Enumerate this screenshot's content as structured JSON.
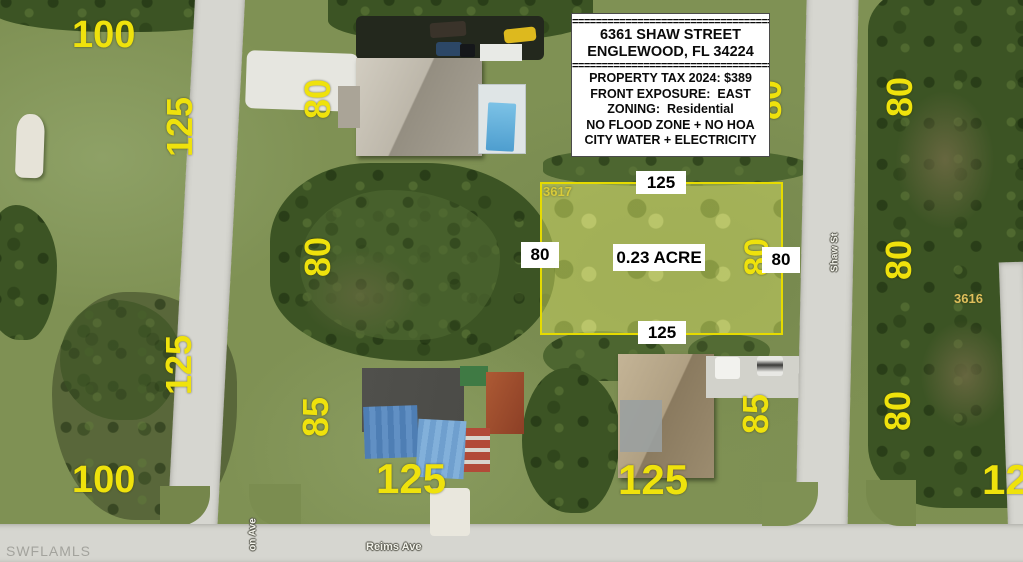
{
  "info_box": {
    "divider": "==================================",
    "address_line1": "6361 SHAW STREET",
    "address_line2": "ENGLEWOOD, FL 34224",
    "detail_lines": [
      "PROPERTY TAX 2024: $389",
      "FRONT EXPOSURE:  EAST",
      "ZONING:  Residential",
      "NO FLOOD ZONE + NO HOA",
      "CITY WATER + ELECTRICITY"
    ]
  },
  "lot": {
    "parcel_number": "3617",
    "area": "0.23 ACRE",
    "frontage_top": "125",
    "frontage_bottom": "125",
    "depth_left": "80",
    "depth_right": "80",
    "depth_inner": "80",
    "outline_color": "#e6db00"
  },
  "dimensions": {
    "tl_100": "100",
    "tl_125": "125",
    "tm_80": "80",
    "mm_80": "80",
    "bm_85": "85",
    "bm_125": "125",
    "bl_125": "125",
    "bl_100": "100",
    "br_85": "85",
    "br_125": "125",
    "tr_80": "80",
    "mr_80": "80",
    "brr_80": "80",
    "edge_125": "125",
    "hidden_80": "80"
  },
  "parcels": {
    "neighbor": "3616"
  },
  "streets": {
    "shaw": "Shaw St",
    "reims": "Reims Ave",
    "left_partial": "on Ave"
  },
  "watermark": "SWFLAMLS",
  "colors": {
    "annotation_yellow": "#efe20c",
    "label_bg": "#ffffff",
    "label_text": "#000000"
  }
}
